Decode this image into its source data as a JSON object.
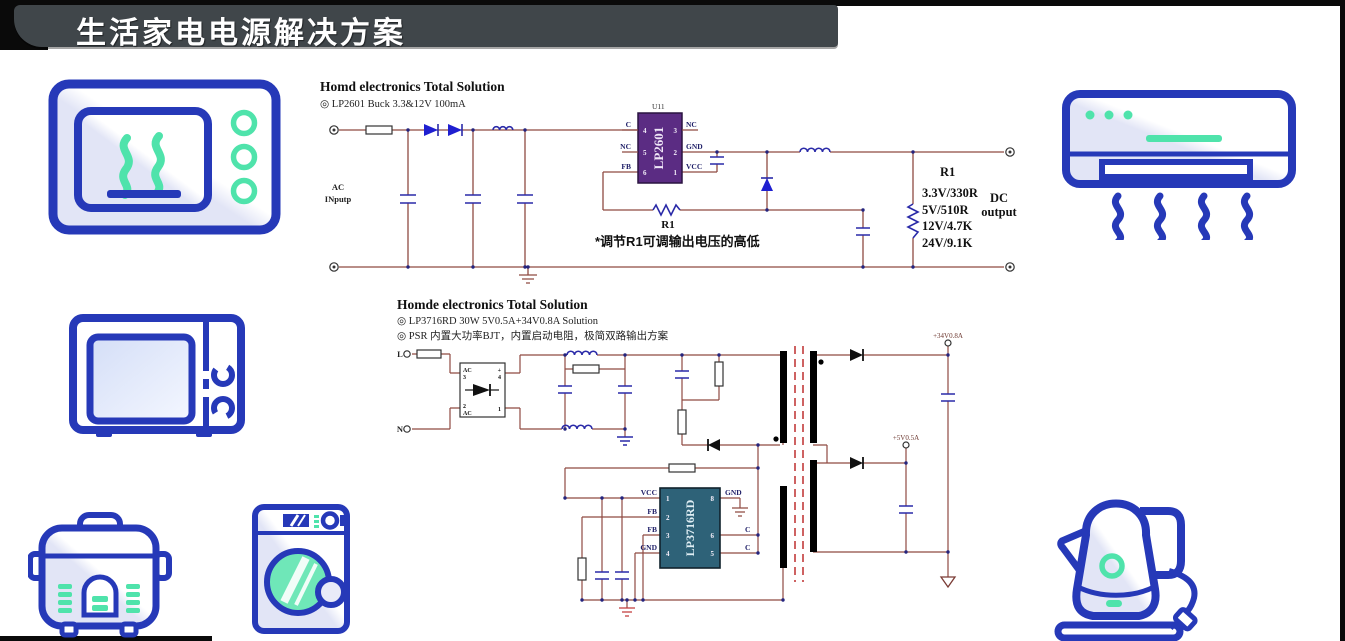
{
  "header": {
    "title": "生活家电电源解决方案"
  },
  "colors": {
    "header_bg": "#40464a",
    "accent_blue": "#2639b8",
    "accent_teal": "#4fe3ab",
    "wire": "#8f4a42",
    "component_navy": "#2a2aa8",
    "ic1_purple": "#5b2c83",
    "ic2_teal": "#2e6278"
  },
  "icons": {
    "top_left": "microwave-oven",
    "top_right": "air-conditioner",
    "mid_left": "microwave",
    "bottom_left": "rice-cooker",
    "bottom_mid": "washing-machine",
    "bottom_right": "electric-kettle"
  },
  "circuit1": {
    "title": "Homd electronics Total  Solution",
    "subtitle": "◎ LP2601 Buck 3.3&12V 100mA",
    "ac_line1": "AC",
    "ac_line2": "INputp",
    "ic": {
      "ref": "U11",
      "name": "LP2601",
      "left_pins": [
        {
          "label": "C",
          "num": "4"
        },
        {
          "label": "NC",
          "num": "5"
        },
        {
          "label": "FB",
          "num": "6"
        }
      ],
      "right_pins": [
        {
          "label": "NC",
          "num": "3"
        },
        {
          "label": "GND",
          "num": "2"
        },
        {
          "label": "VCC",
          "num": "1"
        }
      ]
    },
    "r1_adjust_label": "R1",
    "note": "*调节R1可调输出电压的高低",
    "r1_table": {
      "title": "R1",
      "rows": [
        "3.3V/330R",
        "5V/510R",
        "12V/4.7K",
        "24V/9.1K"
      ]
    },
    "output_line1": "DC",
    "output_line2": "output"
  },
  "circuit2": {
    "title": "Homde electronics Total  Solution",
    "bullet1": "◎ LP3716RD 30W 5V0.5A+34V0.8A Solution",
    "bullet2": "◎ PSR 内置大功率BJT，内置启动电阻，极简双路输出方案",
    "terminal_l": "L",
    "terminal_n": "N",
    "bridge": {
      "tl": "AC",
      "tl_num": "3",
      "tr": "+",
      "tr_num": "4",
      "bl_num": "2",
      "bl": "AC",
      "br_num": "1"
    },
    "ic": {
      "name": "LP3716RD",
      "left_pins": [
        {
          "label": "VCC",
          "num": "1"
        },
        {
          "label": "FB",
          "num": "2"
        },
        {
          "label": "FB",
          "num": "3"
        },
        {
          "label": "GND",
          "num": "4"
        }
      ],
      "right_pins": [
        {
          "label": "GND",
          "num": "8"
        },
        {
          "label": "C",
          "num": "6"
        },
        {
          "label": "C",
          "num": "5"
        }
      ]
    },
    "output_34v": "+34V0.8A",
    "output_5v": "+5V0.5A"
  }
}
